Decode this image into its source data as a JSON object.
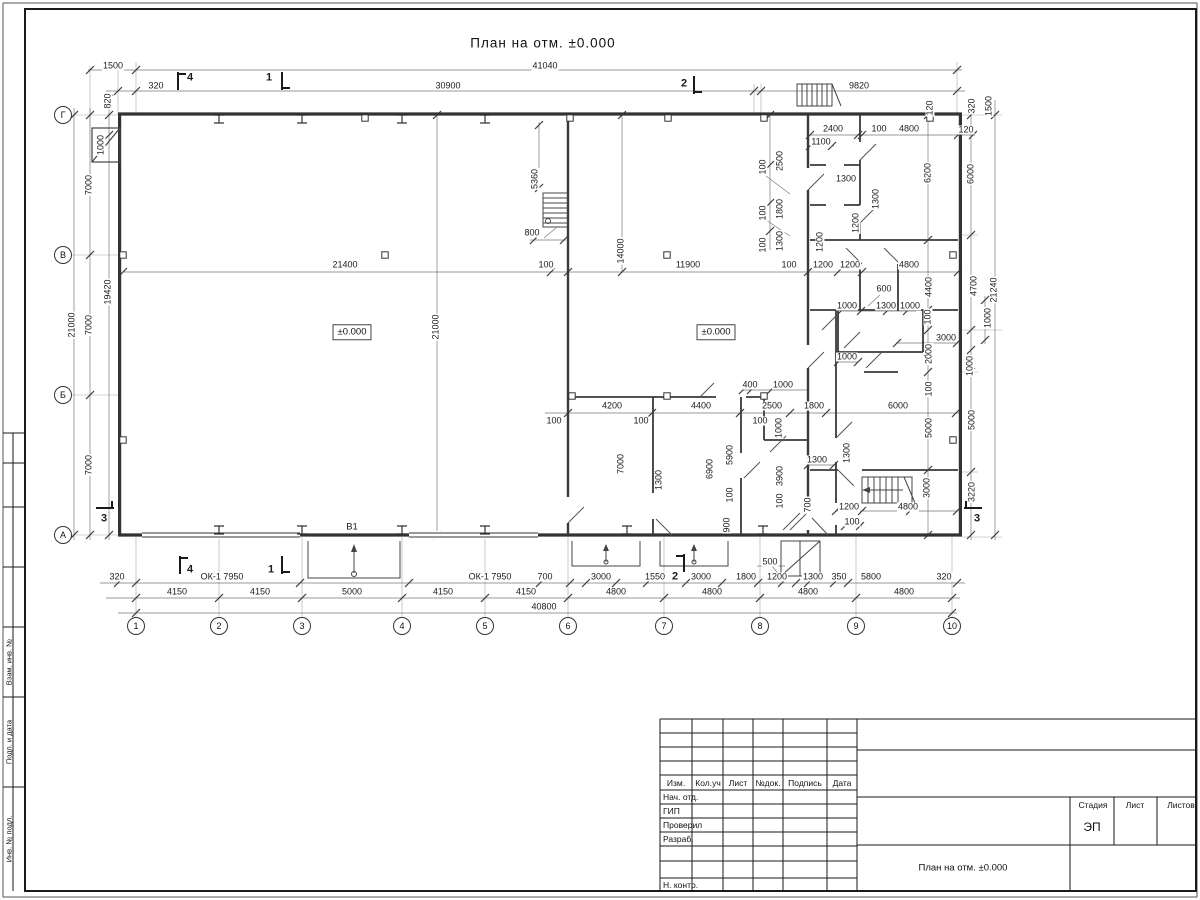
{
  "title": "План на отм. ±0.000",
  "axes": {
    "cols": [
      {
        "label": "1",
        "x": 136
      },
      {
        "label": "2",
        "x": 219
      },
      {
        "label": "3",
        "x": 302
      },
      {
        "label": "4",
        "x": 402
      },
      {
        "label": "5",
        "x": 485
      },
      {
        "label": "6",
        "x": 568
      },
      {
        "label": "7",
        "x": 664
      },
      {
        "label": "8",
        "x": 760
      },
      {
        "label": "9",
        "x": 856
      },
      {
        "label": "10",
        "x": 952
      }
    ],
    "rows": [
      {
        "label": "Г",
        "y": 115
      },
      {
        "label": "В",
        "y": 255
      },
      {
        "label": "Б",
        "y": 395
      },
      {
        "label": "А",
        "y": 535
      }
    ]
  },
  "levels": [
    {
      "text": "±0.000",
      "x": 352,
      "y": 332
    },
    {
      "text": "±0.000",
      "x": 716,
      "y": 332
    }
  ],
  "dim_labels": [
    {
      "t": "1500",
      "x": 113,
      "y": 66
    },
    {
      "t": "41040",
      "x": 545,
      "y": 66
    },
    {
      "t": "320",
      "x": 156,
      "y": 86
    },
    {
      "t": "30900",
      "x": 448,
      "y": 86
    },
    {
      "t": "9820",
      "x": 859,
      "y": 86
    },
    {
      "t": "820",
      "x": 108,
      "y": 101,
      "r": 1
    },
    {
      "t": "1000",
      "x": 101,
      "y": 145,
      "r": 1
    },
    {
      "t": "120",
      "x": 930,
      "y": 108,
      "r": 1
    },
    {
      "t": "320",
      "x": 972,
      "y": 106,
      "r": 1
    },
    {
      "t": "1500",
      "x": 989,
      "y": 106,
      "r": 1
    },
    {
      "t": "2400",
      "x": 833,
      "y": 129
    },
    {
      "t": "100",
      "x": 879,
      "y": 129
    },
    {
      "t": "4800",
      "x": 909,
      "y": 129
    },
    {
      "t": "120",
      "x": 966,
      "y": 130
    },
    {
      "t": "1100",
      "x": 821,
      "y": 142
    },
    {
      "t": "100",
      "x": 763,
      "y": 167,
      "r": 1
    },
    {
      "t": "2500",
      "x": 780,
      "y": 161,
      "r": 1
    },
    {
      "t": "100",
      "x": 763,
      "y": 213,
      "r": 1
    },
    {
      "t": "1800",
      "x": 780,
      "y": 209,
      "r": 1
    },
    {
      "t": "100",
      "x": 763,
      "y": 245,
      "r": 1
    },
    {
      "t": "1300",
      "x": 780,
      "y": 241,
      "r": 1
    },
    {
      "t": "1300",
      "x": 846,
      "y": 179
    },
    {
      "t": "1300",
      "x": 876,
      "y": 199,
      "r": 1
    },
    {
      "t": "1200",
      "x": 856,
      "y": 223,
      "r": 1
    },
    {
      "t": "1200",
      "x": 820,
      "y": 242,
      "r": 1
    },
    {
      "t": "6200",
      "x": 928,
      "y": 173,
      "r": 1
    },
    {
      "t": "6000",
      "x": 971,
      "y": 174,
      "r": 1
    },
    {
      "t": "5360",
      "x": 535,
      "y": 179,
      "r": 1
    },
    {
      "t": "800",
      "x": 532,
      "y": 233
    },
    {
      "t": "7000",
      "x": 89,
      "y": 185,
      "r": 1
    },
    {
      "t": "7000",
      "x": 89,
      "y": 325,
      "r": 1
    },
    {
      "t": "7000",
      "x": 89,
      "y": 465,
      "r": 1
    },
    {
      "t": "21000",
      "x": 72,
      "y": 325,
      "r": 1
    },
    {
      "t": "19420",
      "x": 108,
      "y": 292,
      "r": 1
    },
    {
      "t": "21400",
      "x": 345,
      "y": 265
    },
    {
      "t": "100",
      "x": 546,
      "y": 265
    },
    {
      "t": "14000",
      "x": 621,
      "y": 251,
      "r": 1
    },
    {
      "t": "11900",
      "x": 688,
      "y": 265
    },
    {
      "t": "100",
      "x": 789,
      "y": 265
    },
    {
      "t": "1200",
      "x": 823,
      "y": 265
    },
    {
      "t": "1200",
      "x": 850,
      "y": 265
    },
    {
      "t": "4800",
      "x": 909,
      "y": 265
    },
    {
      "t": "21000",
      "x": 436,
      "y": 327,
      "r": 1
    },
    {
      "t": "4400",
      "x": 929,
      "y": 287,
      "r": 1
    },
    {
      "t": "4700",
      "x": 974,
      "y": 286,
      "r": 1
    },
    {
      "t": "21240",
      "x": 994,
      "y": 290,
      "r": 1
    },
    {
      "t": "600",
      "x": 884,
      "y": 289
    },
    {
      "t": "1000",
      "x": 847,
      "y": 306
    },
    {
      "t": "1300",
      "x": 886,
      "y": 306
    },
    {
      "t": "1000",
      "x": 910,
      "y": 306
    },
    {
      "t": "100",
      "x": 928,
      "y": 317,
      "r": 1
    },
    {
      "t": "1000",
      "x": 988,
      "y": 318,
      "r": 1
    },
    {
      "t": "3000",
      "x": 946,
      "y": 338
    },
    {
      "t": "2000",
      "x": 929,
      "y": 354,
      "r": 1
    },
    {
      "t": "1000",
      "x": 847,
      "y": 357
    },
    {
      "t": "1000",
      "x": 970,
      "y": 366,
      "r": 1
    },
    {
      "t": "100",
      "x": 929,
      "y": 389,
      "r": 1
    },
    {
      "t": "400",
      "x": 750,
      "y": 385
    },
    {
      "t": "1000",
      "x": 783,
      "y": 385
    },
    {
      "t": "4200",
      "x": 612,
      "y": 406
    },
    {
      "t": "4400",
      "x": 701,
      "y": 406
    },
    {
      "t": "2500",
      "x": 772,
      "y": 406
    },
    {
      "t": "1800",
      "x": 814,
      "y": 406
    },
    {
      "t": "6000",
      "x": 898,
      "y": 406
    },
    {
      "t": "100",
      "x": 554,
      "y": 421
    },
    {
      "t": "100",
      "x": 641,
      "y": 421
    },
    {
      "t": "100",
      "x": 760,
      "y": 421
    },
    {
      "t": "1000",
      "x": 779,
      "y": 428,
      "r": 1
    },
    {
      "t": "7000",
      "x": 621,
      "y": 464,
      "r": 1
    },
    {
      "t": "6900",
      "x": 710,
      "y": 469,
      "r": 1
    },
    {
      "t": "5900",
      "x": 730,
      "y": 455,
      "r": 1
    },
    {
      "t": "3900",
      "x": 780,
      "y": 476,
      "r": 1
    },
    {
      "t": "1300",
      "x": 659,
      "y": 480,
      "r": 1
    },
    {
      "t": "1300",
      "x": 817,
      "y": 460
    },
    {
      "t": "1300",
      "x": 847,
      "y": 453,
      "r": 1
    },
    {
      "t": "100",
      "x": 730,
      "y": 495,
      "r": 1
    },
    {
      "t": "100",
      "x": 780,
      "y": 501,
      "r": 1
    },
    {
      "t": "900",
      "x": 727,
      "y": 525,
      "r": 1
    },
    {
      "t": "700",
      "x": 808,
      "y": 505,
      "r": 1
    },
    {
      "t": "5000",
      "x": 929,
      "y": 428,
      "r": 1
    },
    {
      "t": "5000",
      "x": 972,
      "y": 420,
      "r": 1
    },
    {
      "t": "3000",
      "x": 927,
      "y": 488,
      "r": 1
    },
    {
      "t": "3220",
      "x": 972,
      "y": 492,
      "r": 1
    },
    {
      "t": "1200",
      "x": 849,
      "y": 507
    },
    {
      "t": "4800",
      "x": 908,
      "y": 507
    },
    {
      "t": "100",
      "x": 852,
      "y": 522
    },
    {
      "t": "500",
      "x": 770,
      "y": 562
    },
    {
      "t": "В1",
      "x": 352,
      "y": 527,
      "c": "b"
    },
    {
      "t": "320",
      "x": 117,
      "y": 577
    },
    {
      "t": "ОК-1 7950",
      "x": 222,
      "y": 577
    },
    {
      "t": "ОК-1 7950",
      "x": 490,
      "y": 577
    },
    {
      "t": "700",
      "x": 545,
      "y": 577
    },
    {
      "t": "3000",
      "x": 601,
      "y": 577
    },
    {
      "t": "1550",
      "x": 655,
      "y": 577
    },
    {
      "t": "3000",
      "x": 701,
      "y": 577
    },
    {
      "t": "1800",
      "x": 746,
      "y": 577
    },
    {
      "t": "1200",
      "x": 777,
      "y": 577
    },
    {
      "t": "1300",
      "x": 813,
      "y": 577
    },
    {
      "t": "350",
      "x": 839,
      "y": 577
    },
    {
      "t": "5800",
      "x": 871,
      "y": 577
    },
    {
      "t": "320",
      "x": 944,
      "y": 577
    },
    {
      "t": "4150",
      "x": 177,
      "y": 592
    },
    {
      "t": "4150",
      "x": 260,
      "y": 592
    },
    {
      "t": "5000",
      "x": 352,
      "y": 592
    },
    {
      "t": "4150",
      "x": 443,
      "y": 592
    },
    {
      "t": "4150",
      "x": 526,
      "y": 592
    },
    {
      "t": "4800",
      "x": 616,
      "y": 592
    },
    {
      "t": "4800",
      "x": 712,
      "y": 592
    },
    {
      "t": "4800",
      "x": 808,
      "y": 592
    },
    {
      "t": "4800",
      "x": 904,
      "y": 592
    },
    {
      "t": "40800",
      "x": 544,
      "y": 607
    },
    {
      "t": "4",
      "x": 190,
      "y": 78,
      "c": "s"
    },
    {
      "t": "1",
      "x": 269,
      "y": 78,
      "c": "s"
    },
    {
      "t": "2",
      "x": 684,
      "y": 84,
      "c": "s"
    },
    {
      "t": "4",
      "x": 190,
      "y": 570,
      "c": "s"
    },
    {
      "t": "1",
      "x": 271,
      "y": 570,
      "c": "s"
    },
    {
      "t": "2",
      "x": 675,
      "y": 577,
      "c": "s"
    },
    {
      "t": "3",
      "x": 104,
      "y": 519,
      "c": "s"
    },
    {
      "t": "3",
      "x": 977,
      "y": 519,
      "c": "s"
    }
  ],
  "frame": {
    "side_labels": [
      "Взам. инв. №",
      "Подп. и дата",
      "Инв. № подл."
    ]
  },
  "titleblock": {
    "rev_headers": [
      "Изм.",
      "Кол.уч",
      "Лист",
      "№док.",
      "Подпись",
      "Дата"
    ],
    "sign_rows": [
      "Нач. отд.",
      "ГИП",
      "Проверил",
      "Разраб.",
      "Н. контр."
    ],
    "stage_headers": [
      "Стадия",
      "Лист",
      "Листов"
    ],
    "stage": "ЭП",
    "doc_title": "План на отм. ±0.000"
  }
}
